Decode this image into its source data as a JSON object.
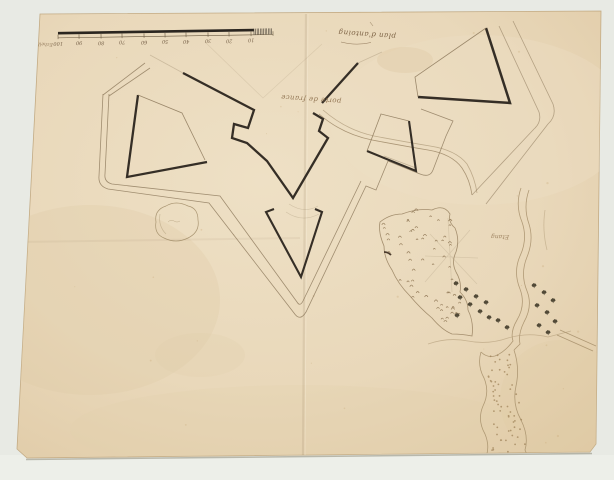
{
  "document": {
    "kind": "scanned manuscript fortification plan on aged paper"
  },
  "title": {
    "text": "plan d'antoing"
  },
  "scale_bar": {
    "label": "Echelle",
    "ticks": [
      "100",
      "90",
      "80",
      "70",
      "60",
      "50",
      "40",
      "30",
      "20",
      "10"
    ]
  },
  "labels": {
    "gate": "porte de france",
    "pond": "Etang"
  },
  "colors": {
    "background": "#e8eae4",
    "paper": "#e9d8ba",
    "paper_edge": "#c3ab84",
    "ink_dark": "#352e26",
    "ink_thin": "#8d795c",
    "handwriting": "#7c6244",
    "pencil": "#8f7e60",
    "river": "#a68f6a",
    "marsh": "#8d7452",
    "tree": "#4c4434"
  }
}
